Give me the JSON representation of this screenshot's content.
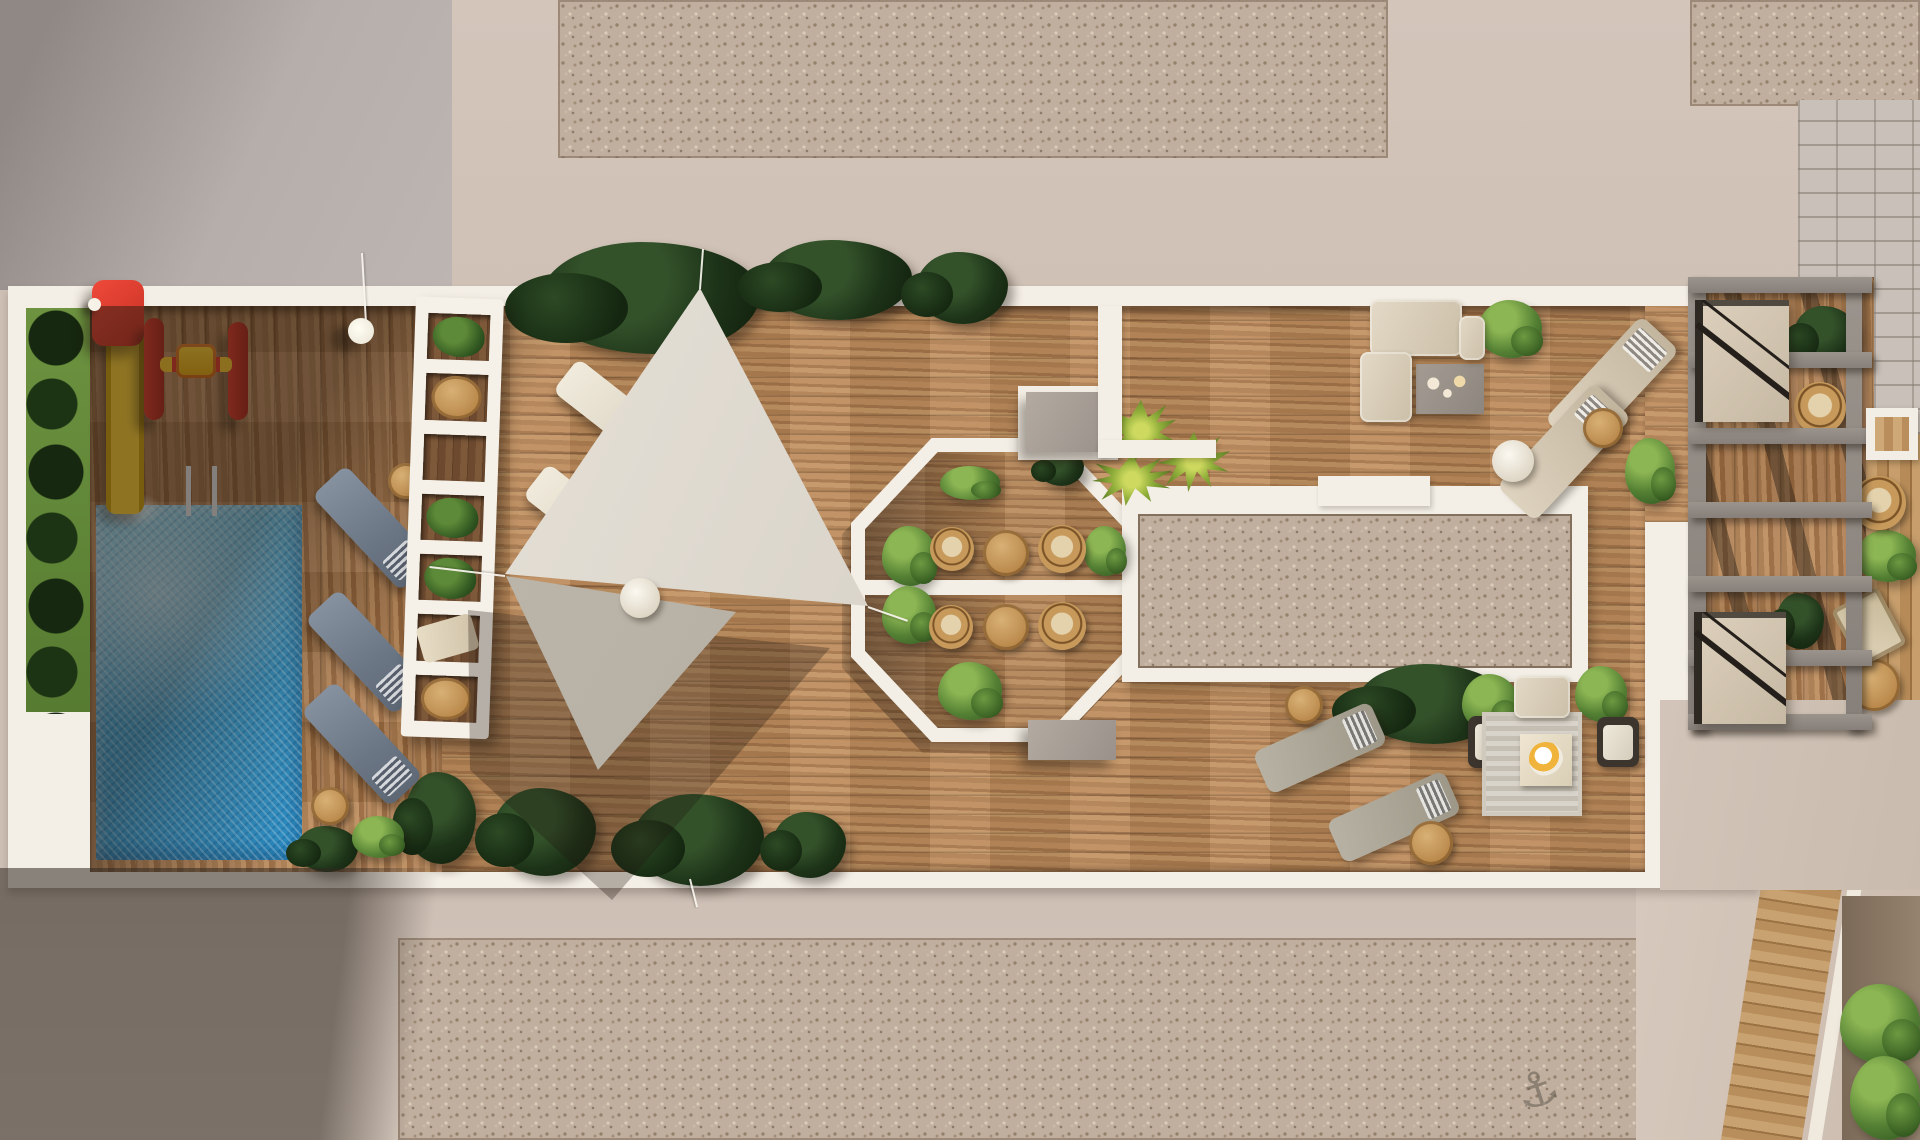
{
  "scene": {
    "subject": "aerial-3d-render-rooftop-terrace",
    "glyphs": {
      "anchor": "⚓"
    },
    "palette": {
      "concrete_gray": "#b6aeaa",
      "concrete_shadow": "#8f8885",
      "concrete_beige": "#d3c5ba",
      "gravel": "#c0af9f",
      "slab_white": "#f4efe6",
      "wood_light": "#bd8c5c",
      "wood_dark": "#7d5839",
      "pool_blue": "#3aa0d4",
      "pool_highlight": "#7fd0ec",
      "grass_green": "#6d9340",
      "hedge_green": "#1d3318",
      "bush_green": "#548034",
      "palm_green": "#8fae3a",
      "sail_fabric": "#d5cfc4",
      "pergola_white": "#f5f1e8",
      "trellis_gray": "#918a84",
      "rattan_tan": "#c79a5c",
      "lounger_blue_gray": "#6b7685",
      "lounger_beige": "#ded3bf",
      "sofa_beige": "#e3d9c6",
      "rug_gray": "#d9d4cb",
      "brick_gray": "#c9c1b9",
      "slide_red": "#ef4a3a",
      "slide_yellow": "#f6ce35"
    },
    "pergola_holes": [
      "plant",
      "table",
      "empty",
      "plant",
      "plant",
      "lounger",
      "table"
    ],
    "items": [
      {
        "n": "plant-tropical",
        "v": "bushD",
        "b": [
          540,
          242,
          220,
          112
        ]
      },
      {
        "n": "plant-tropical",
        "v": "bushD",
        "b": [
          762,
          240,
          150,
          80
        ]
      },
      {
        "n": "plant-tropical",
        "v": "bushD",
        "b": [
          916,
          252,
          92,
          72
        ]
      },
      {
        "n": "plant-tropical",
        "v": "bushD",
        "b": [
          404,
          772,
          72,
          92
        ]
      },
      {
        "n": "plant-tropical",
        "v": "bushD",
        "b": [
          492,
          788,
          104,
          88
        ]
      },
      {
        "n": "plant-tropical",
        "v": "bushD",
        "b": [
          632,
          794,
          132,
          92
        ]
      },
      {
        "n": "plant-tropical",
        "v": "bushD",
        "b": [
          772,
          812,
          74,
          66
        ]
      },
      {
        "n": "plant-tropical",
        "v": "bushD",
        "b": [
          296,
          826,
          62,
          46
        ]
      },
      {
        "n": "plant-tropical",
        "v": "bushD",
        "b": [
          1356,
          664,
          150,
          80
        ]
      },
      {
        "n": "plant-bush",
        "v": "bushL",
        "b": [
          1478,
          300,
          64,
          58
        ]
      },
      {
        "n": "plant-bush",
        "v": "bushL",
        "b": [
          1625,
          438,
          50,
          66
        ]
      },
      {
        "n": "plant-bush",
        "v": "bushL",
        "b": [
          1462,
          674,
          56,
          58
        ]
      },
      {
        "n": "plant-bush",
        "v": "bushL",
        "b": [
          1575,
          666,
          52,
          56
        ]
      },
      {
        "n": "plant-bush",
        "v": "bushL",
        "b": [
          882,
          526,
          54,
          60
        ]
      },
      {
        "n": "plant-bush",
        "v": "bushL",
        "b": [
          1084,
          526,
          42,
          50
        ]
      },
      {
        "n": "plant-bush",
        "v": "bushL",
        "b": [
          882,
          586,
          54,
          58
        ]
      },
      {
        "n": "plant-bush",
        "v": "bushL",
        "b": [
          938,
          662,
          64,
          58
        ]
      },
      {
        "n": "plant-bush",
        "v": "bushL",
        "b": [
          940,
          466,
          60,
          34
        ]
      },
      {
        "n": "plant-tropical",
        "v": "bushD",
        "b": [
          1038,
          450,
          46,
          36
        ]
      },
      {
        "n": "plant-palm",
        "v": "palm",
        "b": [
          1106,
          400,
          70,
          62
        ]
      },
      {
        "n": "plant-palm",
        "v": "palm",
        "b": [
          1092,
          454,
          80,
          52
        ]
      },
      {
        "n": "plant-palm",
        "v": "palm",
        "b": [
          1158,
          432,
          72,
          60
        ]
      },
      {
        "n": "plant-tropical",
        "v": "bushD",
        "b": [
          1793,
          306,
          64,
          60
        ]
      },
      {
        "n": "plant-bush",
        "v": "bushL",
        "b": [
          1856,
          530,
          60,
          52
        ]
      },
      {
        "n": "plant-tropical",
        "v": "bushD",
        "b": [
          1776,
          593,
          48,
          56
        ]
      },
      {
        "n": "plant-bush",
        "v": "bushL",
        "b": [
          1840,
          984,
          80,
          80
        ]
      },
      {
        "n": "plant-bush",
        "v": "bushL",
        "b": [
          1850,
          1056,
          70,
          84
        ]
      },
      {
        "n": "plant-bush",
        "v": "bushL",
        "b": [
          352,
          816,
          52,
          42
        ]
      },
      {
        "n": "sun-lounger",
        "v": "lounger lngB",
        "b": [
          308,
          505,
          130,
          46
        ],
        "r": 47
      },
      {
        "n": "sun-lounger",
        "v": "lounger lngB",
        "b": [
          301,
          629,
          130,
          46
        ],
        "r": 47
      },
      {
        "n": "sun-lounger",
        "v": "lounger lngB",
        "b": [
          297,
          721,
          130,
          46
        ],
        "r": 47
      },
      {
        "n": "sun-lounger",
        "v": "lounger lngW",
        "b": [
          553,
          390,
          118,
          42
        ],
        "r": 38
      },
      {
        "n": "sun-lounger",
        "v": "lounger lngW",
        "b": [
          523,
          495,
          118,
          42
        ],
        "r": 38
      },
      {
        "n": "sun-lounger",
        "v": "lounger lngT",
        "b": [
          1541,
          359,
          142,
          52
        ],
        "r": -47
      },
      {
        "n": "sun-lounger",
        "v": "lounger lngT",
        "b": [
          1493,
          426,
          142,
          52
        ],
        "r": -47
      },
      {
        "n": "sun-lounger",
        "v": "lounger lngG",
        "b": [
          1256,
          725,
          128,
          46
        ],
        "r": -24
      },
      {
        "n": "sun-lounger",
        "v": "lounger lngG",
        "b": [
          1330,
          794,
          128,
          46
        ],
        "r": -24
      },
      {
        "n": "side-table",
        "v": "tblW",
        "b": [
          388,
          463,
          36,
          36
        ]
      },
      {
        "n": "side-table",
        "v": "tblW",
        "b": [
          311,
          787,
          38,
          38
        ]
      },
      {
        "n": "side-table",
        "v": "tblW",
        "b": [
          591,
          453,
          30,
          30
        ]
      },
      {
        "n": "side-table",
        "v": "tblW",
        "b": [
          1583,
          408,
          40,
          40
        ]
      },
      {
        "n": "side-table",
        "v": "tblW",
        "b": [
          1285,
          686,
          38,
          38
        ]
      },
      {
        "n": "side-table",
        "v": "tblW",
        "b": [
          1409,
          821,
          44,
          44
        ]
      },
      {
        "n": "side-table",
        "v": "tblW",
        "b": [
          1848,
          659,
          52,
          52
        ]
      },
      {
        "n": "dining-table",
        "v": "tblW",
        "b": [
          983,
          530,
          46,
          46
        ]
      },
      {
        "n": "dining-table",
        "v": "tblW",
        "b": [
          983,
          604,
          46,
          46
        ]
      },
      {
        "n": "side-table",
        "v": "tblWh",
        "b": [
          1492,
          440,
          42,
          42
        ]
      },
      {
        "n": "rattan-chair",
        "v": "chR",
        "b": [
          930,
          527,
          44,
          44
        ]
      },
      {
        "n": "rattan-chair",
        "v": "chR",
        "b": [
          1038,
          525,
          48,
          48
        ]
      },
      {
        "n": "rattan-chair",
        "v": "chR",
        "b": [
          929,
          605,
          44,
          44
        ]
      },
      {
        "n": "rattan-chair",
        "v": "chR",
        "b": [
          1038,
          602,
          48,
          48
        ]
      },
      {
        "n": "rattan-chair",
        "v": "chR",
        "b": [
          1794,
          382,
          52,
          52
        ]
      },
      {
        "n": "rattan-chair",
        "v": "chR",
        "b": [
          1852,
          476,
          54,
          54
        ]
      },
      {
        "n": "armchair",
        "v": "chA",
        "b": [
          1468,
          716,
          46,
          52
        ]
      },
      {
        "n": "armchair",
        "v": "chA",
        "b": [
          1597,
          717,
          42,
          50
        ]
      },
      {
        "n": "deck-chair",
        "v": "fold",
        "b": [
          1843,
          595,
          52,
          64
        ],
        "r": -28
      },
      {
        "n": "walkway-slab",
        "v": "wblock",
        "b": [
          1018,
          386,
          100,
          74
        ]
      },
      {
        "n": "concrete-bench",
        "v": "gblock",
        "b": [
          1026,
          392,
          84,
          60
        ]
      },
      {
        "n": "concrete-bench",
        "v": "gblock",
        "b": [
          1028,
          720,
          88,
          40
        ]
      },
      {
        "n": "walkway-slab",
        "v": "wblock",
        "b": [
          1318,
          476,
          112,
          30
        ]
      },
      {
        "n": "walkway-slab",
        "v": "wblock",
        "b": [
          1098,
          306,
          24,
          152
        ]
      },
      {
        "n": "walkway-slab",
        "v": "wblock",
        "b": [
          1098,
          440,
          118,
          18
        ]
      },
      {
        "n": "coffee-table",
        "v": "ctable",
        "b": [
          1416,
          364,
          68,
          50
        ]
      },
      {
        "n": "outdoor-rug",
        "v": "rug",
        "b": [
          1482,
          712,
          100,
          104
        ]
      },
      {
        "n": "coffee-table",
        "v": "rtable2",
        "b": [
          1520,
          734,
          52,
          52
        ]
      },
      {
        "n": "sofa",
        "v": "sofa",
        "b": [
          1370,
          300,
          92,
          56
        ]
      },
      {
        "n": "sofa",
        "v": "sofa",
        "b": [
          1360,
          352,
          52,
          70
        ]
      },
      {
        "n": "sofa",
        "v": "sofa",
        "b": [
          1459,
          316,
          26,
          44
        ]
      },
      {
        "n": "sofa",
        "v": "sofa",
        "b": [
          1514,
          676,
          56,
          42
        ]
      },
      {
        "n": "pergola-beam",
        "v": "beamV",
        "b": [
          1688,
          277,
          18,
          453
        ]
      },
      {
        "n": "pergola-beam",
        "v": "beamV",
        "b": [
          1846,
          277,
          16,
          453
        ]
      },
      {
        "n": "pergola-beam",
        "v": "beamH",
        "b": [
          1688,
          277,
          184,
          16
        ]
      },
      {
        "n": "pergola-beam",
        "v": "beamH",
        "b": [
          1688,
          352,
          184,
          16
        ]
      },
      {
        "n": "pergola-beam",
        "v": "beamH",
        "b": [
          1688,
          428,
          184,
          16
        ]
      },
      {
        "n": "pergola-beam",
        "v": "beamH",
        "b": [
          1688,
          502,
          184,
          16
        ]
      },
      {
        "n": "pergola-beam",
        "v": "beamH",
        "b": [
          1688,
          576,
          184,
          16
        ]
      },
      {
        "n": "pergola-beam",
        "v": "beamH",
        "b": [
          1688,
          650,
          184,
          16
        ]
      },
      {
        "n": "pergola-beam",
        "v": "beamH",
        "b": [
          1688,
          714,
          184,
          16
        ]
      },
      {
        "n": "stair-opening",
        "v": "stair",
        "b": [
          1695,
          300,
          94,
          122
        ]
      },
      {
        "n": "stair-opening",
        "v": "stair",
        "b": [
          1694,
          612,
          92,
          112
        ]
      },
      {
        "n": "skylight",
        "v": "skylight",
        "b": [
          1866,
          408,
          52,
          52
        ]
      }
    ],
    "cables": [
      [
        505,
        575,
        430,
        566
      ],
      [
        700,
        288,
        703,
        248
      ],
      [
        868,
        606,
        908,
        620
      ],
      [
        690,
        878,
        697,
        906
      ],
      [
        366,
        322,
        362,
        252
      ]
    ]
  }
}
